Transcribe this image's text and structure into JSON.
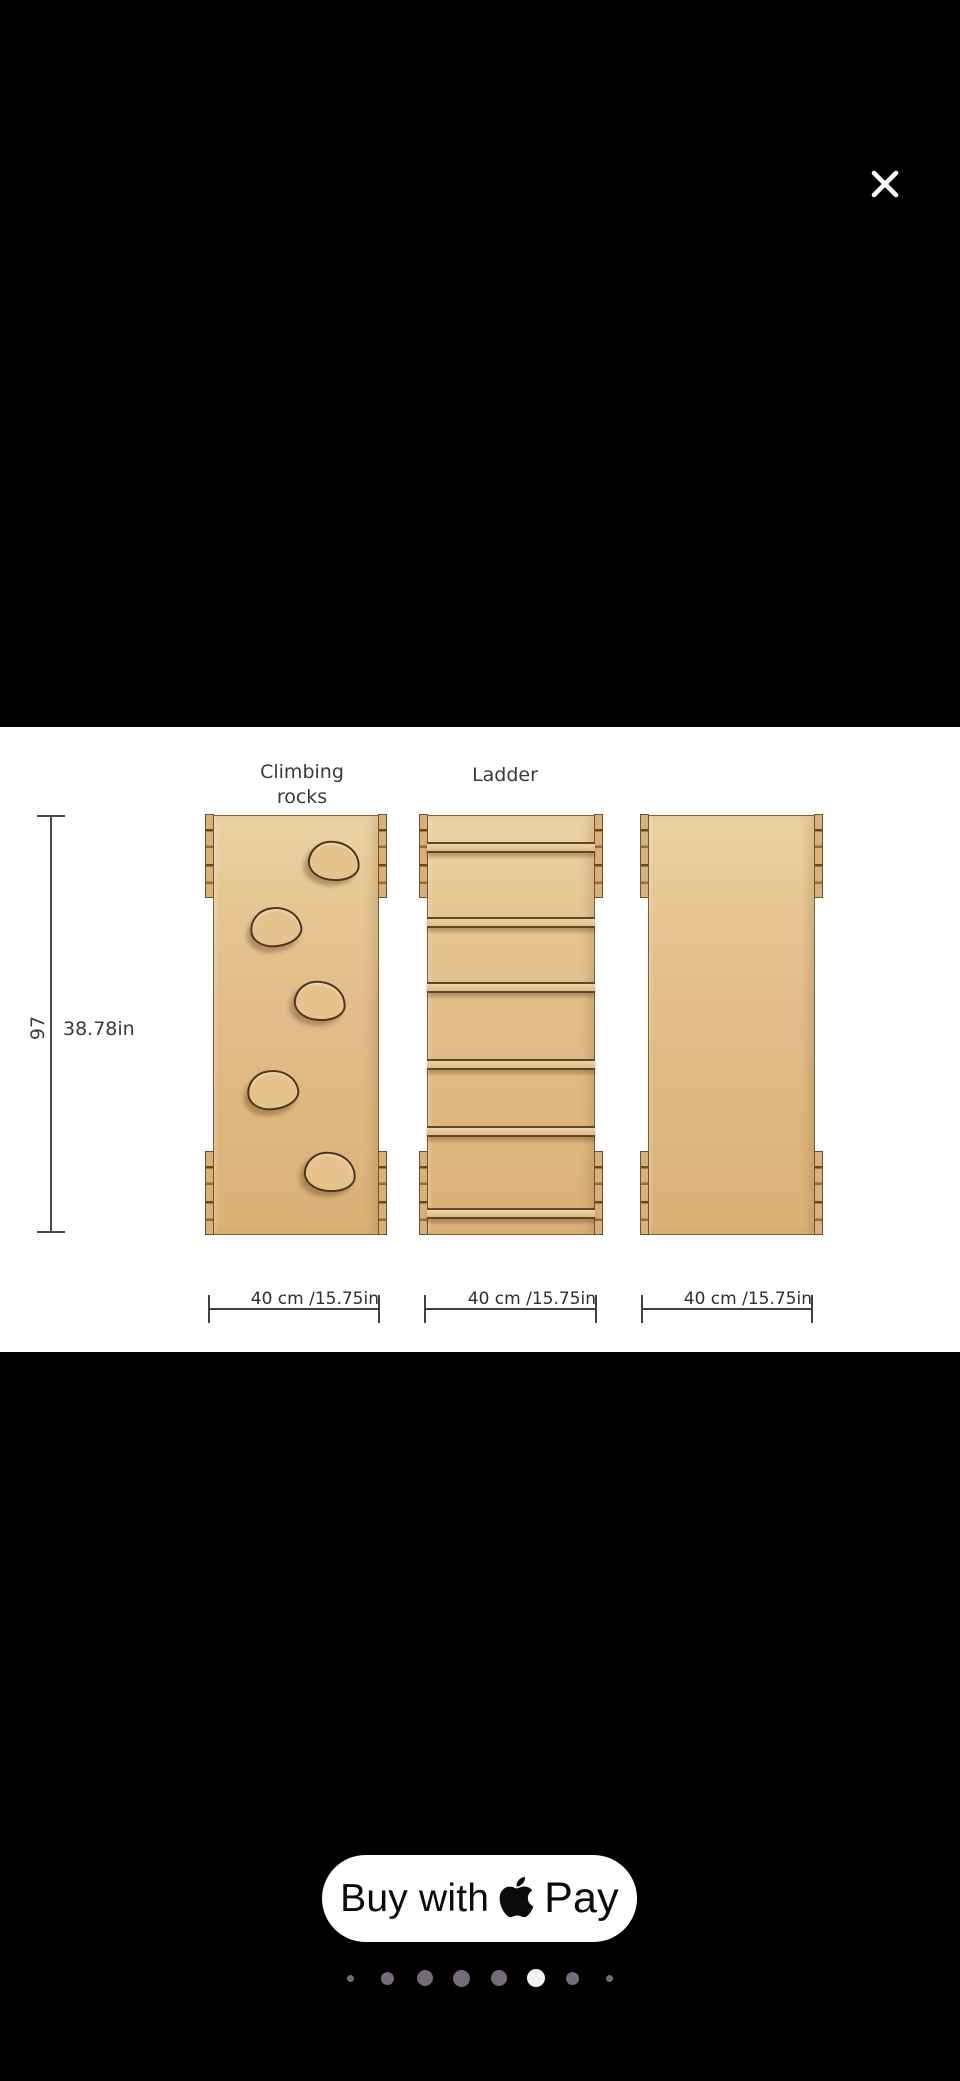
{
  "lightbox": {
    "close_label": "Close"
  },
  "diagram": {
    "labels": {
      "left_panel": "Climbing\nrocks",
      "middle_panel": "Ladder"
    },
    "height_dimension": {
      "cm": "97",
      "inches": "38.78in"
    },
    "width_dimension": {
      "panel1": "40 cm /15.75in",
      "panel2": "40 cm /15.75in",
      "panel3": "40 cm /15.75in"
    },
    "panels": [
      {
        "id": "climbing-rocks",
        "rocks": [
          {
            "x": 120,
            "y": 45
          },
          {
            "x": 62,
            "y": 111
          },
          {
            "x": 106,
            "y": 185
          },
          {
            "x": 59,
            "y": 274
          },
          {
            "x": 116,
            "y": 356
          }
        ]
      },
      {
        "id": "ladder",
        "rungs": [
          26,
          101,
          166,
          243,
          310,
          392
        ]
      },
      {
        "id": "plain"
      }
    ],
    "wood_color": "#e2bd8a",
    "outline_color": "#6d5330"
  },
  "checkout": {
    "buy_prefix": "Buy with",
    "brand": "Pay",
    "logo": "apple-logo"
  },
  "carousel": {
    "active_index": 5,
    "inactive_color": "#766b78",
    "active_color": "#f5f2f5",
    "dots": [
      {
        "size": 7,
        "active": false
      },
      {
        "size": 13,
        "active": false
      },
      {
        "size": 16,
        "active": false
      },
      {
        "size": 17,
        "active": false
      },
      {
        "size": 16,
        "active": false
      },
      {
        "size": 18,
        "active": true
      },
      {
        "size": 13,
        "active": false
      },
      {
        "size": 7,
        "active": false
      }
    ]
  }
}
